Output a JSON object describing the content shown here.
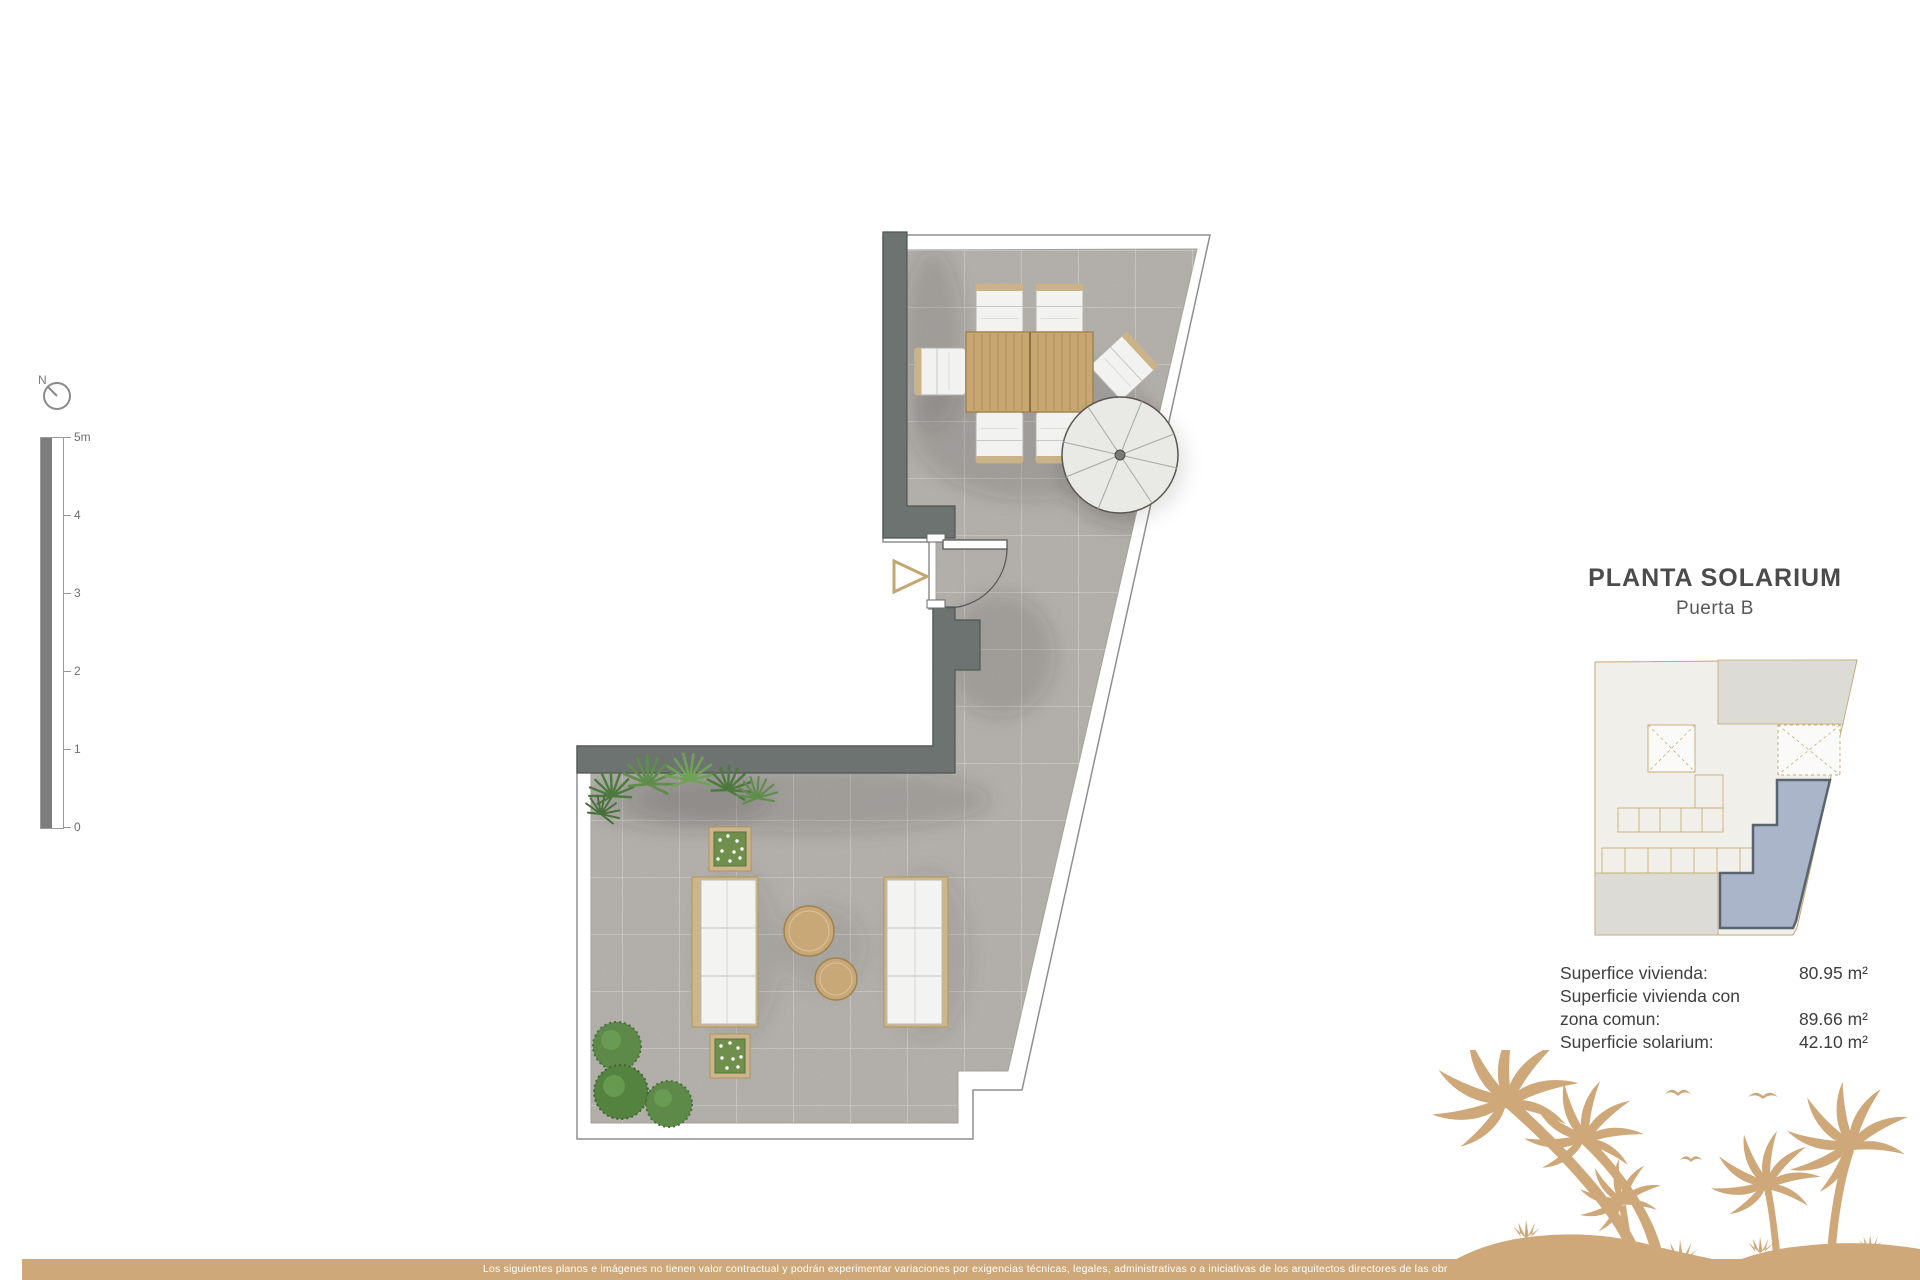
{
  "header": {
    "title": "PLANTA SOLARIUM",
    "subtitle": "Puerta B"
  },
  "areas": {
    "rows": [
      {
        "label": "Superfice vivienda:",
        "value": "80.95 m²"
      },
      {
        "label": "Superficie vivienda con",
        "value": ""
      },
      {
        "label": "zona comun:",
        "value": "89.66 m²"
      },
      {
        "label": "Superficie solarium:",
        "value": "42.10 m²"
      }
    ]
  },
  "scale_bar": {
    "ticks": [
      "5m",
      "4",
      "3",
      "2",
      "1",
      "0"
    ]
  },
  "compass": {
    "label": "N"
  },
  "footer": {
    "disclaimer": "Los siguientes planos e imágenes no tienen valor contractual y podrán experimentar variaciones por exigencias técnicas, legales, administrativas o a iniciativas de los arquitectos directores de las obras"
  },
  "colors": {
    "accent_tan": "#cfa87a",
    "unit_highlight": "#abb5c9",
    "wall_gray": "#6d7370",
    "floor_gray": "#b4b1ac"
  }
}
